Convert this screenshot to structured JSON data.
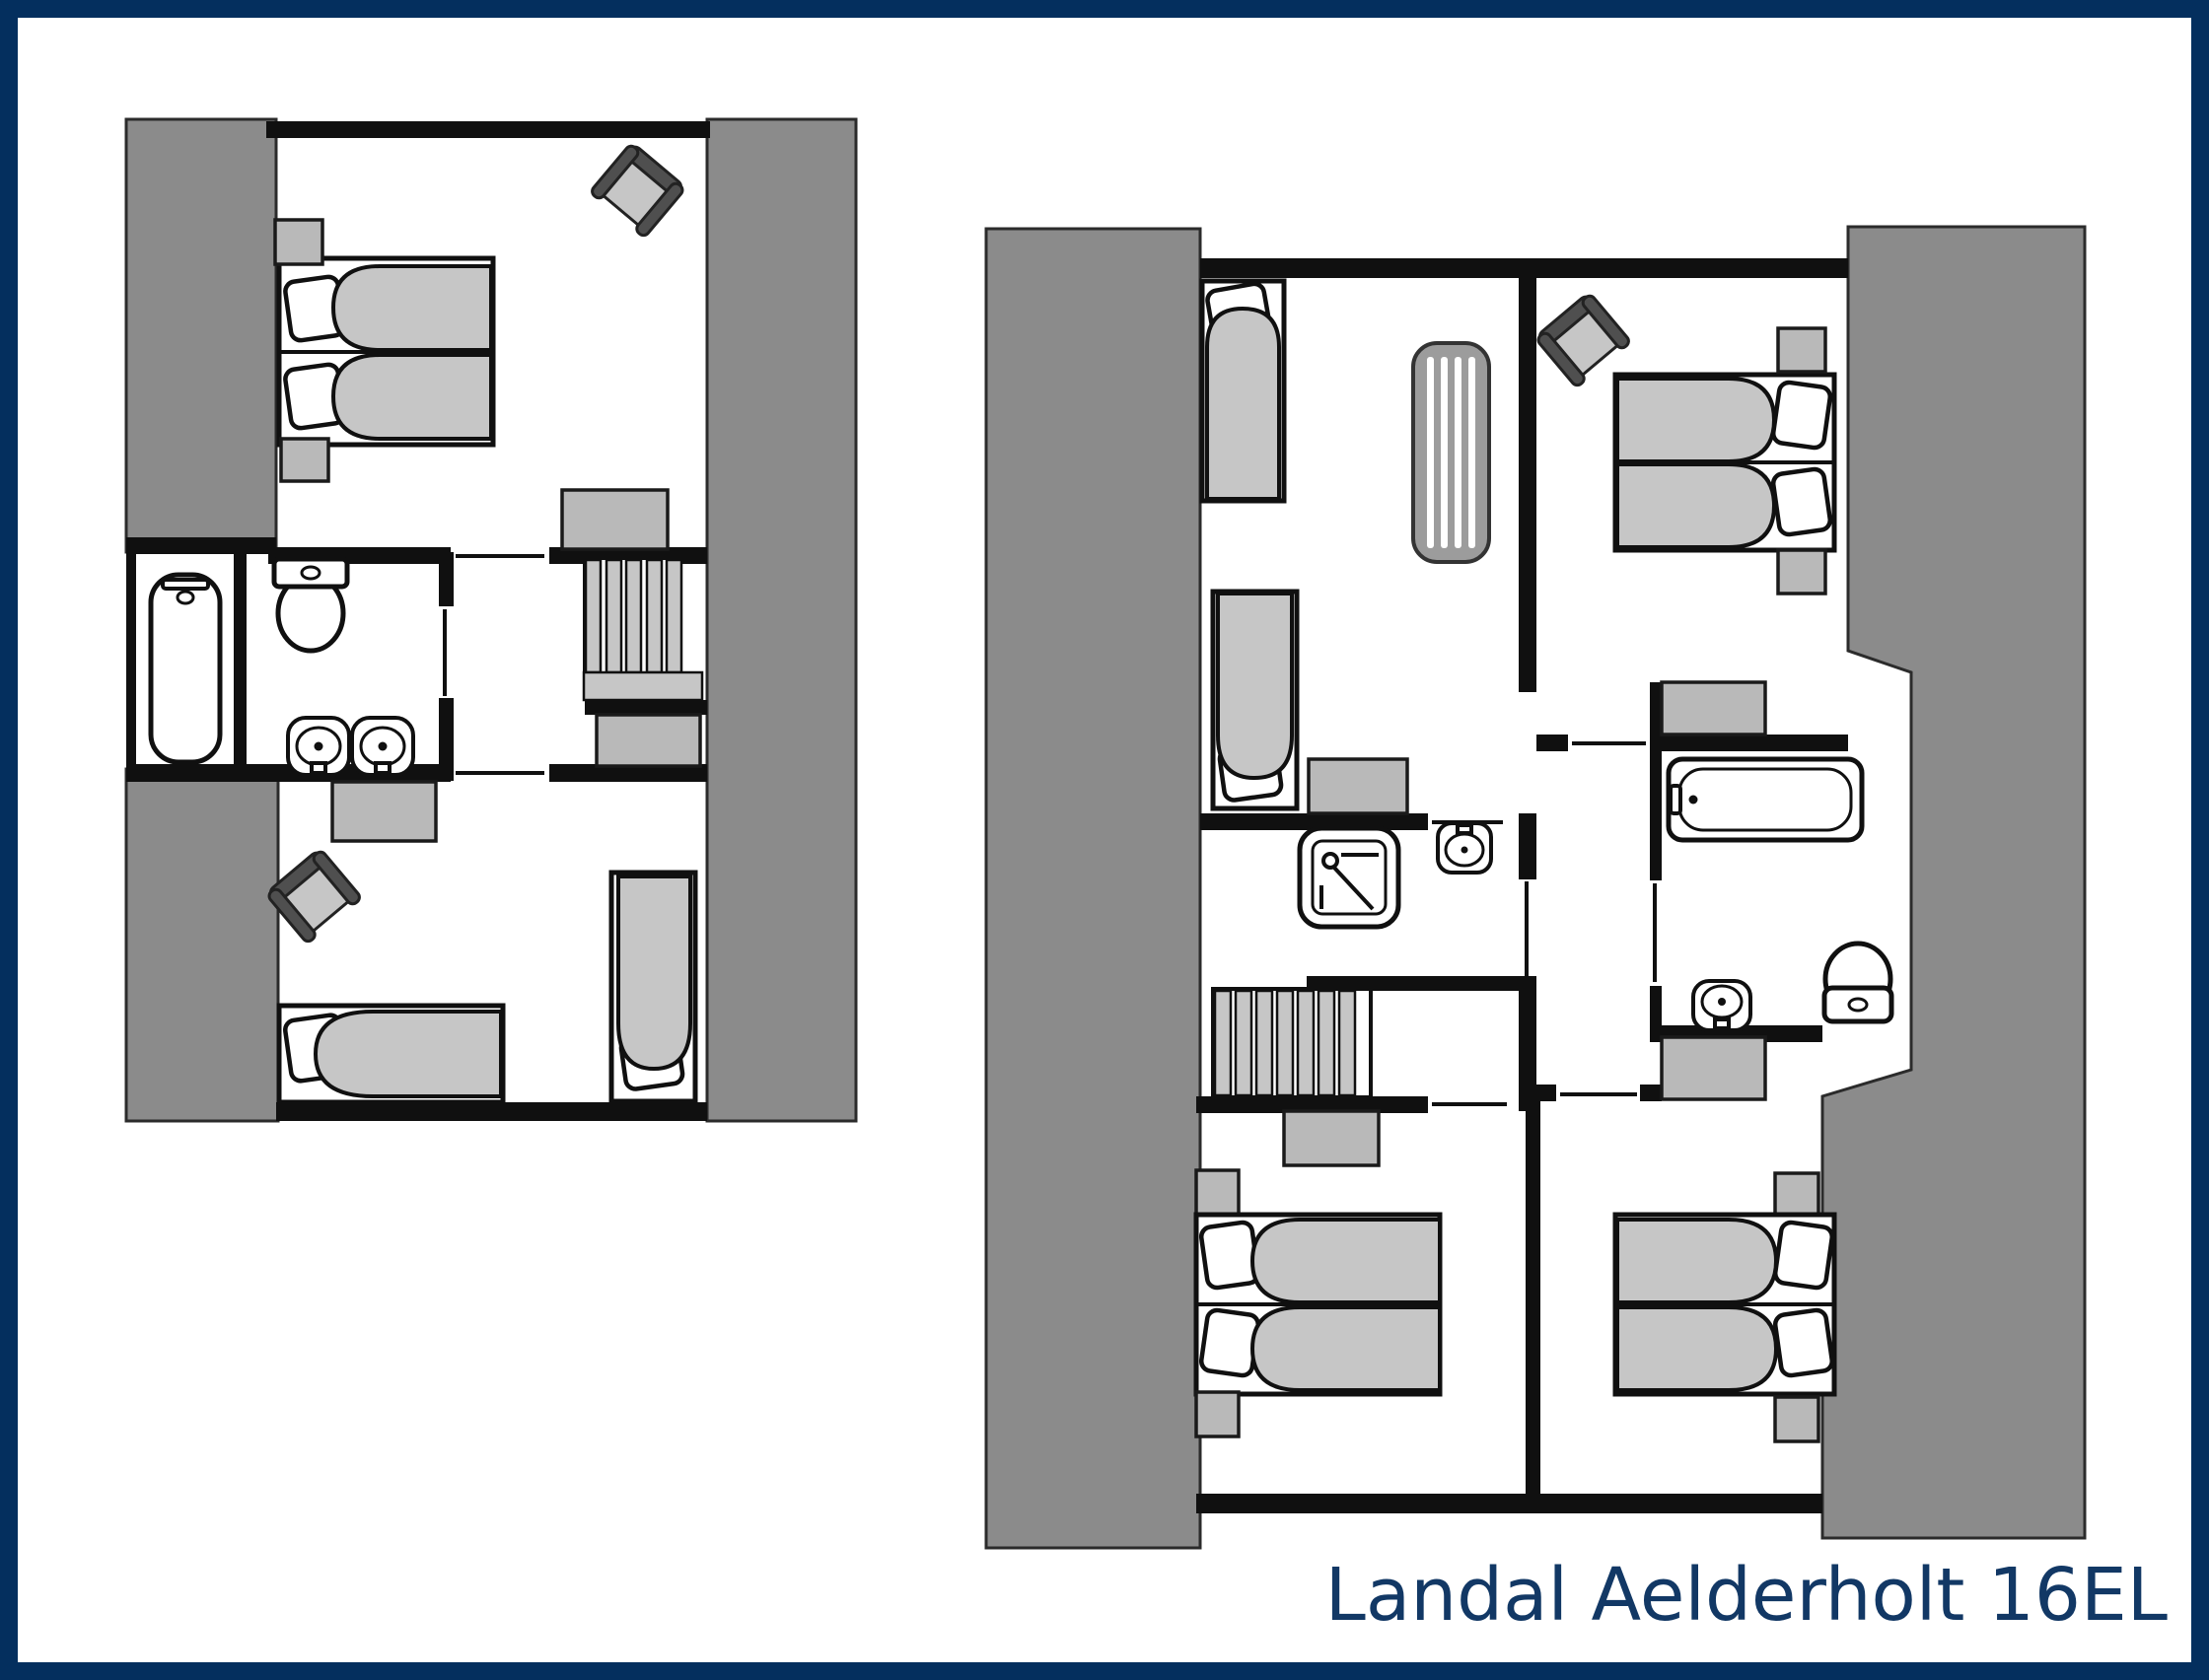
{
  "title": "Landal Aelderholt 16EL",
  "colors": {
    "background": "#ffffff",
    "border": "#042f5e",
    "title": "#123865",
    "wall": "#101010",
    "band": "#8b8b8b",
    "light": "#c6c6c6",
    "mid": "#b9b9b9",
    "chair": "#4f4f4f",
    "cot": "#9c9c9c"
  },
  "plans": [
    {
      "id": "plan-upper-left",
      "furniture": [
        "double-bed",
        "pillow",
        "pillow",
        "nightstand",
        "nightstand",
        "chair",
        "dresser",
        "bathtub",
        "toilet",
        "washbasin",
        "washbasin",
        "stairs",
        "wardrobe",
        "dresser",
        "chair",
        "single-bed",
        "single-bed"
      ]
    },
    {
      "id": "plan-main-right",
      "furniture": [
        "single-bed",
        "single-bed",
        "cot",
        "nightstand",
        "chair",
        "double-bed",
        "pillow",
        "pillow",
        "nightstand",
        "nightstand",
        "cabinet",
        "bathtub",
        "washbasin",
        "toilet",
        "shower",
        "washbasin",
        "stairs",
        "dresser",
        "nightstand",
        "double-bed",
        "nightstand",
        "dresser",
        "nightstand",
        "double-bed",
        "nightstand"
      ]
    }
  ]
}
